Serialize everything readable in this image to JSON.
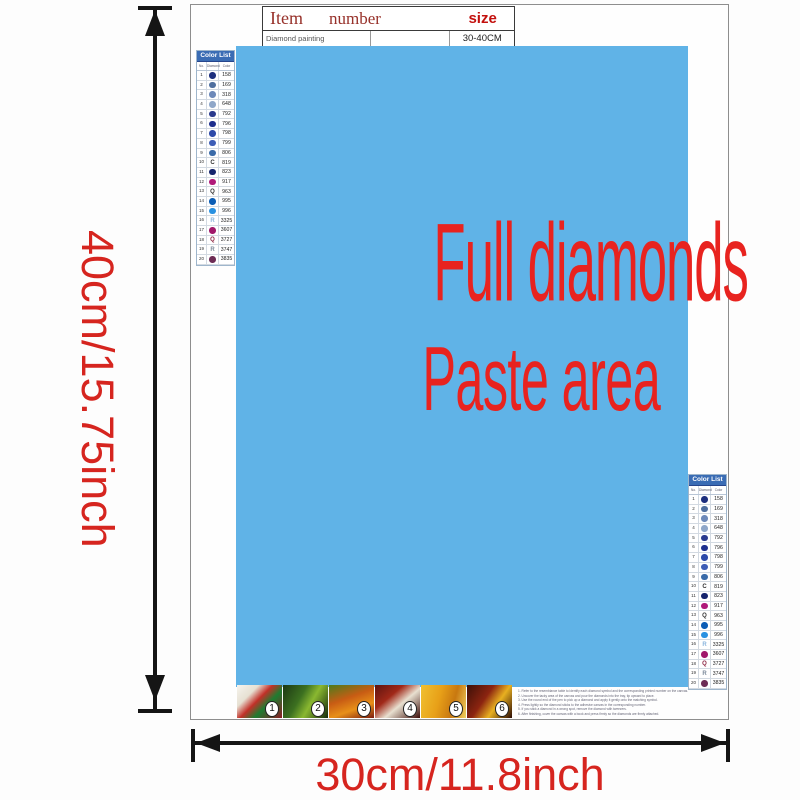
{
  "dimensions": {
    "vertical": "40cm/15.75inch",
    "horizontal": "30cm/11.8inch",
    "label_color": "#d6251f"
  },
  "item_table": {
    "headers": [
      "Item",
      "number",
      "size"
    ],
    "row": [
      "Diamond painting",
      "",
      "30-40CM"
    ]
  },
  "paste_area": {
    "line1": "Full diamonds",
    "line2": "Paste area",
    "bg": "#60b3e7",
    "text_color": "#e8231f"
  },
  "color_list": {
    "title": "Color List",
    "columns": [
      "No.",
      "Diamond",
      "Color"
    ],
    "header_bg": "#3a6cb4",
    "rows": [
      {
        "no": "1",
        "sym": "circle",
        "color": "#1d2f7e",
        "code": "158"
      },
      {
        "no": "2",
        "sym": "circle",
        "color": "#4f6f9f",
        "code": "169"
      },
      {
        "no": "3",
        "sym": "circle",
        "color": "#6d89b9",
        "code": "318"
      },
      {
        "no": "4",
        "sym": "circle",
        "color": "#8fa7c9",
        "code": "648"
      },
      {
        "no": "5",
        "sym": "circle",
        "color": "#2a3a8e",
        "code": "792"
      },
      {
        "no": "6",
        "sym": "circle",
        "color": "#1d2f8e",
        "code": "796"
      },
      {
        "no": "7",
        "sym": "circle",
        "color": "#2d4aa9",
        "code": "798"
      },
      {
        "no": "8",
        "sym": "circle",
        "color": "#3d5db6",
        "code": "799"
      },
      {
        "no": "9",
        "sym": "circle",
        "color": "#3a6ba9",
        "code": "806"
      },
      {
        "no": "10",
        "sym": "letter",
        "color": "#333333",
        "glyph": "C",
        "code": "819"
      },
      {
        "no": "11",
        "sym": "circle",
        "color": "#15246d",
        "code": "823"
      },
      {
        "no": "12",
        "sym": "circle",
        "color": "#b01979",
        "code": "917"
      },
      {
        "no": "13",
        "sym": "letter",
        "color": "#333333",
        "glyph": "Q",
        "code": "963"
      },
      {
        "no": "14",
        "sym": "circle",
        "color": "#0b5db5",
        "code": "995"
      },
      {
        "no": "15",
        "sym": "circle",
        "color": "#2991e1",
        "code": "996"
      },
      {
        "no": "16",
        "sym": "letter",
        "color": "#8ab5dd",
        "glyph": "R",
        "code": "3325"
      },
      {
        "no": "17",
        "sym": "circle",
        "color": "#a1186a",
        "code": "3607"
      },
      {
        "no": "18",
        "sym": "letter",
        "color": "#8d2441",
        "glyph": "Q",
        "code": "3727"
      },
      {
        "no": "19",
        "sym": "letter",
        "color": "#7c8a9a",
        "glyph": "R",
        "code": "3747"
      },
      {
        "no": "20",
        "sym": "circle",
        "color": "#6d2c55",
        "code": "3835"
      }
    ]
  },
  "steps": {
    "thumbs": [
      {
        "number": "1",
        "bg": "linear-gradient(135deg,#f6f4ee 0%,#e6e0d2 28%,#c23028 46%,#1f7c30 64%,#8c1c24 100%)"
      },
      {
        "number": "2",
        "bg": "linear-gradient(120deg,#1c3814 0%,#3c7020 38%,#8ab830 60%,#142a0c 100%)"
      },
      {
        "number": "3",
        "bg": "linear-gradient(160deg,#4c7c1c 0%,#c85c14 40%,#e89018 68%,#7c1c10 100%)"
      },
      {
        "number": "4",
        "bg": "linear-gradient(140deg,#5c1410 0%,#a02818 34%,#e8e0d0 58%,#3c0c08 100%)"
      },
      {
        "number": "5",
        "bg": "linear-gradient(105deg,#f0c030 0%,#e8a018 40%,#c87810 70%,#f0d060 100%)"
      },
      {
        "number": "6",
        "bg": "linear-gradient(125deg,#3c1008 0%,#8c2410 40%,#e8b020 64%,#2c0c04 100%)"
      }
    ]
  },
  "instructions": {
    "lines": [
      "1. Refer to the resemblance table to identify each diamond symbol and the corresponding printed number on the canvas.",
      "2. Uncover the tacky area of the canvas and pour the diamonds into the tray, tip upward to place.",
      "3. Use the round end of the pen to pick up a diamond and apply it gently onto the matching symbol.",
      "4. Press lightly so the diamond sticks to the adhesive canvas in the corresponding number.",
      "5. If you stick a diamond in a wrong spot, remove the diamond with tweezers.",
      "6. After finishing, cover the canvas with a book and press firmly so the diamonds are firmly attached."
    ]
  }
}
